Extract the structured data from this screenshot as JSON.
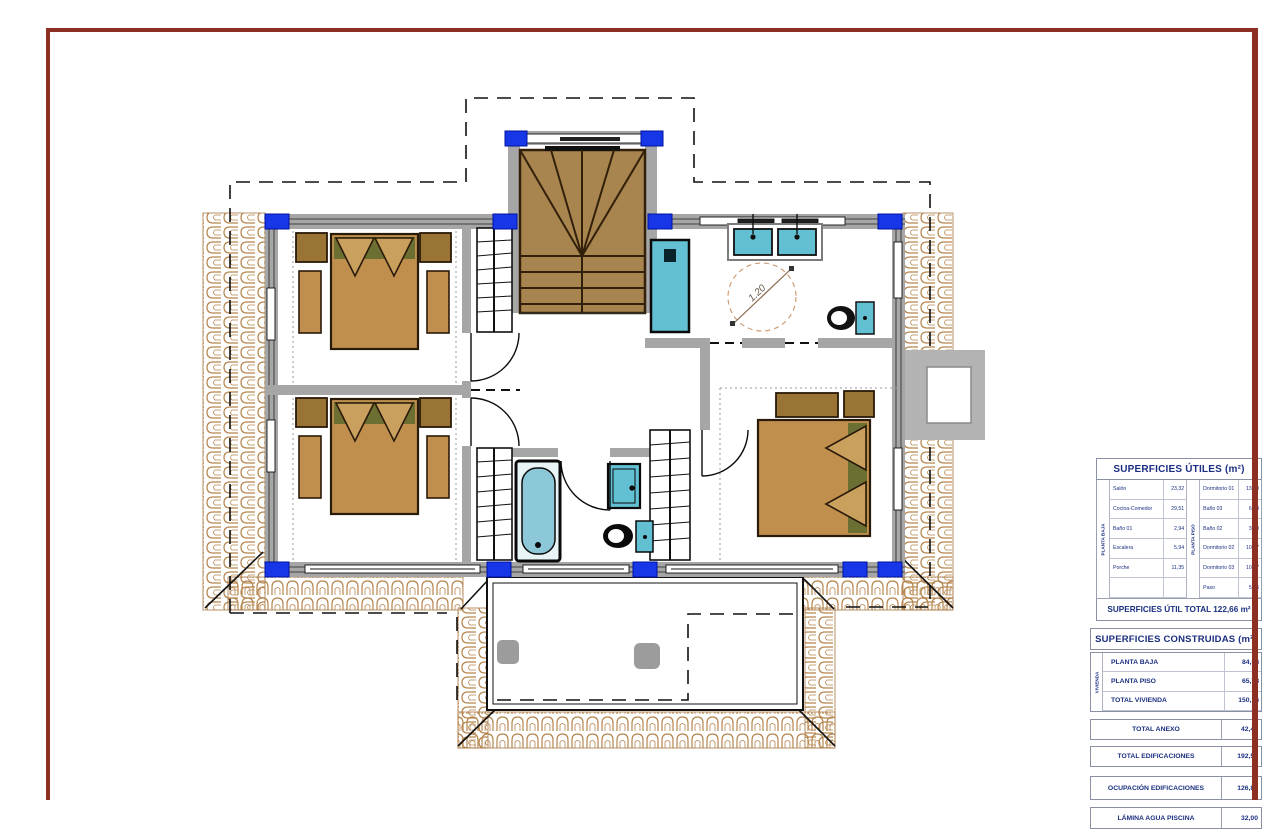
{
  "sheet": {
    "frame_color": "#8e2f23"
  },
  "plan": {
    "turning_circle_label": "1.20"
  },
  "tables": {
    "utiles": {
      "title": "SUPERFICIES ÚTILES (m²)",
      "groups": [
        {
          "label": "PLANTA BAJA",
          "rows": [
            [
              "Salón",
              "23,32"
            ],
            [
              "Cocina-Comedor",
              "29,51"
            ],
            [
              "Baño 01",
              "2,94"
            ],
            [
              "Escalera",
              "5,94"
            ],
            [
              "Porche",
              "11,35"
            ],
            [
              "",
              ""
            ]
          ]
        },
        {
          "label": "PLANTA PISO",
          "rows": [
            [
              "Dormitorio 01",
              "13,30"
            ],
            [
              "Baño 03",
              "6,84"
            ],
            [
              "Baño 02",
              "3,10"
            ],
            [
              "Dormitorio 02",
              "10,07"
            ],
            [
              "Dormitorio 03",
              "10,07"
            ],
            [
              "Paso",
              "5,36"
            ]
          ]
        }
      ],
      "total": "SUPERFICIES ÚTIL TOTAL 122,66 m²"
    },
    "construidas": {
      "title": "SUPERFICIES CONSTRUIDAS (m²)",
      "group_label": "VIVIENDA",
      "vivienda_rows": [
        [
          "PLANTA BAJA",
          "84,38"
        ],
        [
          "PLANTA PISO",
          "65,78"
        ],
        [
          "TOTAL VIVIENDA",
          "150,16"
        ]
      ],
      "summary_rows": [
        [
          "TOTAL ANEXO",
          "42,42"
        ],
        [
          "TOTAL EDIFICACIONES",
          "192,58"
        ],
        [
          "OCUPACIÓN EDIFICACIONES",
          "126,80"
        ],
        [
          "LÁMINA AGUA PISCINA",
          "32,00"
        ]
      ]
    }
  }
}
